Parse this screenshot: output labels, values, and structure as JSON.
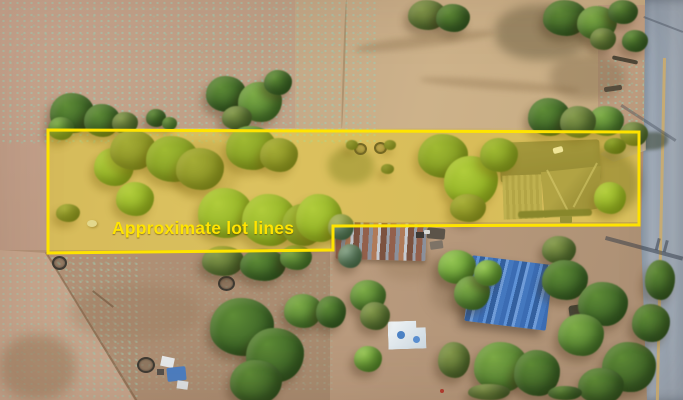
{
  "annotation": {
    "lot_label": "Approximate lot lines",
    "line_color": "#FFE400",
    "fill_opacity": 0.28,
    "lot_polygon_points": "48,130 639,132 639,225 333,226 333,250 48,253"
  },
  "scene": {
    "type": "aerial-drone-photo",
    "palette": {
      "dirt_pink": "#C6A38C",
      "dry_grass": "#CDB285",
      "soil_brown": "#AF8D72",
      "road_asphalt": "#8E9BAA",
      "road_centerline": "#CBB078",
      "tree_green": "#4F7D2F",
      "house_roof": "#827D54",
      "blue_metal_roof": "#4478BF",
      "rust_roof": "#93604B"
    },
    "features": [
      "highlighted-lot",
      "house",
      "rusted-shed",
      "blue-roof-building",
      "white-shed",
      "road",
      "trees",
      "tires",
      "tarp-debris"
    ]
  }
}
